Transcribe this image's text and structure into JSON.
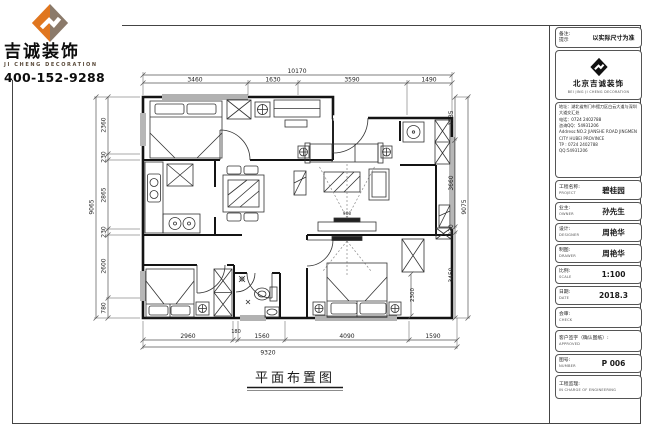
{
  "logo": {
    "company_cn": "吉诚装饰",
    "company_en": "JI CHENG DECORATION",
    "phone": "400-152-9288"
  },
  "plan": {
    "title": "平面布置图",
    "interior_dims": {
      "master_wall": "2300",
      "tv_note": "900"
    }
  },
  "dims": {
    "top": {
      "total": "10170",
      "segments": [
        "3460",
        "1630",
        "3590",
        "1490"
      ]
    },
    "bottom": {
      "total": "9320",
      "segments": [
        "2960",
        "180",
        "1560",
        "4090",
        "1590"
      ]
    },
    "left": {
      "total": "9065",
      "segments": [
        "2360",
        "230",
        "2865",
        "230",
        "2600",
        "780"
      ]
    },
    "right": {
      "total": "9075",
      "segments": [
        "1735",
        "3660",
        "230",
        "3450"
      ]
    }
  },
  "titleblock": {
    "remark": {
      "label1": "备注:",
      "label2": "提示",
      "value": "以实际尺寸为准"
    },
    "company": {
      "name_cn": "北京吉诚装饰",
      "name_en": "BEI JING JI CHENG DECORATION"
    },
    "contact": {
      "address_cn": "地址：湖北省荆门市掇刀区白云大道与深圳大道交汇处",
      "phone_cn": "电话：0724 2402788",
      "qq_cn": "咨询QQ：54931206",
      "address_en": "Address:NO.2 JIANSHE ROAD JINGMEN CITY HUBEI PROVINCE",
      "phone_en": "TP : 0724 2402788",
      "qq_en": "QQ:54931206"
    },
    "fields": [
      {
        "label_cn": "工程名称:",
        "label_en": "PROJECT",
        "value": "碧桂园"
      },
      {
        "label_cn": "业主:",
        "label_en": "OWNER",
        "value": "孙先生"
      },
      {
        "label_cn": "设计:",
        "label_en": "DESIGNER",
        "value": "周艳华"
      },
      {
        "label_cn": "制图:",
        "label_en": "DRAWER",
        "value": "周艳华"
      },
      {
        "label_cn": "比例:",
        "label_en": "SCALE",
        "value": "1:100"
      },
      {
        "label_cn": "日期:",
        "label_en": "DATE",
        "value": "2018.3"
      },
      {
        "label_cn": "会审:",
        "label_en": "CHECK",
        "value": ""
      },
      {
        "label_cn": "客户签字（确认图纸）:",
        "label_en": "APPROVED",
        "value": ""
      },
      {
        "label_cn": "图号:",
        "label_en": "NUMBER",
        "value": "P 006"
      },
      {
        "label_cn": "工程监理:",
        "label_en": "IN CHARGE OF ENGINEERING",
        "value": ""
      }
    ]
  },
  "colors": {
    "logo_orange": "#e0761f",
    "logo_taupe": "#8b7a6a",
    "line": "#111111"
  }
}
